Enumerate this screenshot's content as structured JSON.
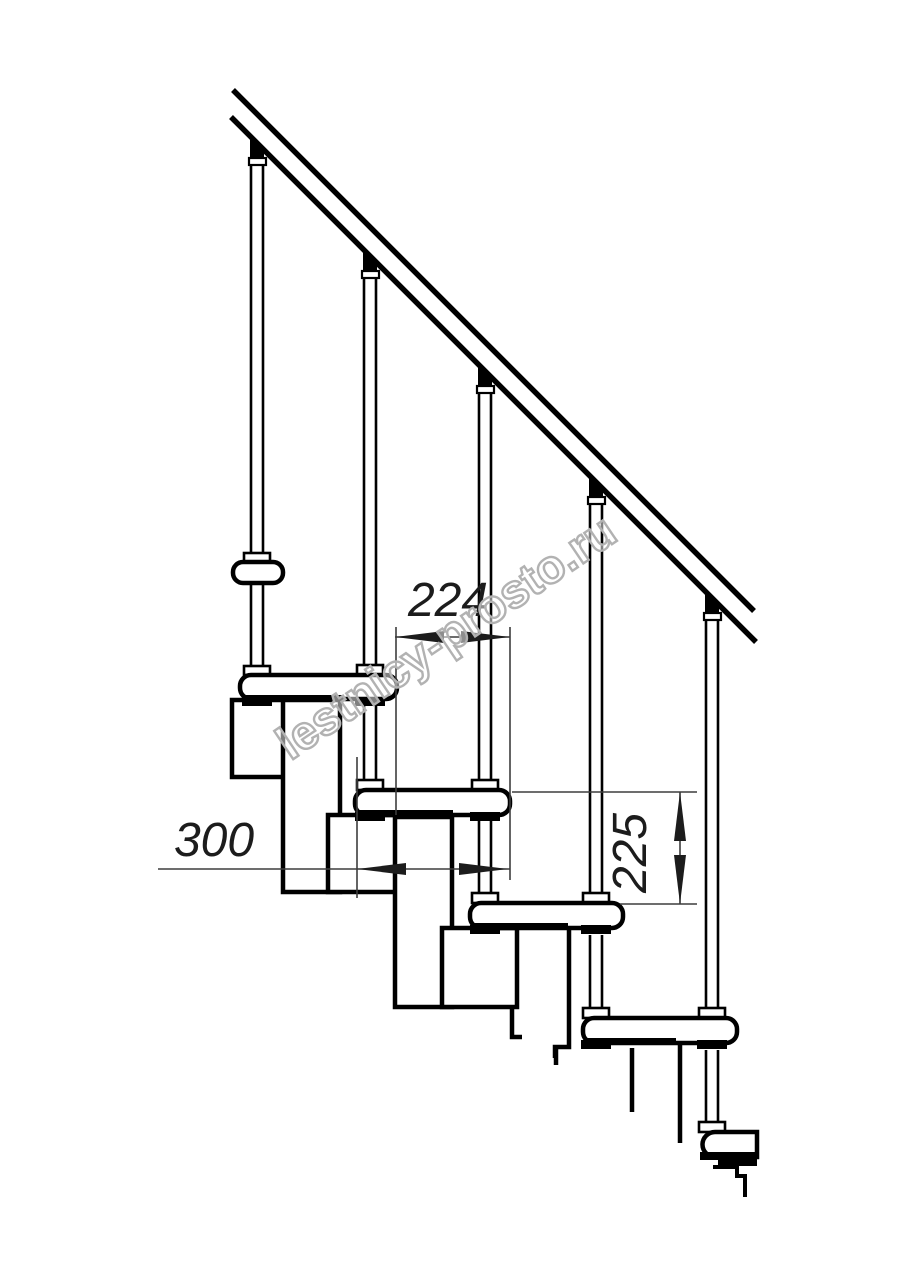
{
  "meta": {
    "title": "Modular staircase side-view technical drawing",
    "background": "#ffffff",
    "line_color": "#000000",
    "dim_line_color": "#3d3d3d"
  },
  "dimensions": {
    "run_label": "224",
    "depth_label": "300",
    "rise_label": "225"
  },
  "watermark": {
    "text": "lestnicy-prosto.ru",
    "color": "#b2b2b2"
  }
}
